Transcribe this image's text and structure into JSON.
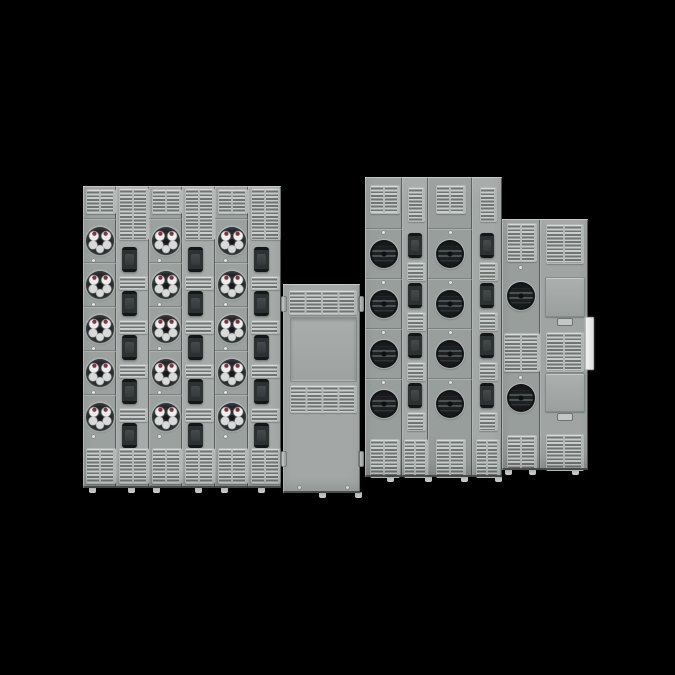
{
  "background": "#000000",
  "product_name": "group-meter-bank-switchboard-render",
  "colors": {
    "panelMeterA": "#9ba19f",
    "panelBreakerA": "#a6aba9",
    "panelMeterC": "#989e9c",
    "panelBreakerC": "#a4a9a7",
    "panelBlank": "#a3a8a6",
    "panelDoorCol": "#a0a5a3",
    "ventFrame": "#b4b9b7",
    "ventSlat": "#c9cdcb",
    "ventSlot": "#6f7573",
    "handleBody": "#2c3132",
    "handleCap": "#141617",
    "handleInner": "#454a4c",
    "socketDark": "#1e2122",
    "socketStripe": "#4b5052",
    "chromeJaw": "#eceeed",
    "chromeJawShade": "#d7dad8",
    "redTerminal": "#8a2f3f",
    "doorFace": "#abb0ae",
    "latchFace": "#c3c7c5",
    "tabFace": "#bfc4c2",
    "footFace": "#ccd0ce",
    "hingeFace": "#f1f3f2",
    "screwFace": "#e4e7e5"
  },
  "banks": [
    {
      "id": "left-meter-bank",
      "x": 83,
      "y": 186,
      "w": 198,
      "h": 302,
      "style": "ring",
      "vent": {
        "w": 28,
        "mTop": 3,
        "mH": 23,
        "bkTop": 2,
        "bkH": 50,
        "bTop": 262,
        "bH": 34
      },
      "meter": {
        "top": 32,
        "pitch": 44,
        "d": 28,
        "screw": "bottom"
      },
      "bk": {
        "top": 61,
        "pitch": 44,
        "hw": 15,
        "hh": 25,
        "hdx": -3,
        "so": 29,
        "sw": 27,
        "sh": 12,
        "tvw": 28,
        "tvsub": 2,
        "bvw": 28
      },
      "columns": [
        {
          "type": "meter",
          "meters": 5,
          "bg": "panelMeterA"
        },
        {
          "type": "breaker",
          "breakers": 5,
          "strips": 4,
          "bg": "panelBreakerA"
        },
        {
          "type": "meter",
          "meters": 5,
          "bg": "panelMeterA"
        },
        {
          "type": "breaker",
          "breakers": 5,
          "strips": 4,
          "bg": "panelBreakerA"
        },
        {
          "type": "meter",
          "meters": 5,
          "bg": "panelMeterA"
        },
        {
          "type": "breaker",
          "breakers": 5,
          "strips": 4,
          "bg": "panelBreakerA"
        }
      ],
      "feet": [
        0.045,
        0.24,
        0.37,
        0.58,
        0.71,
        0.9
      ]
    },
    {
      "id": "center-blank-section",
      "x": 283,
      "y": 284,
      "w": 77,
      "h": 209,
      "style": "blank",
      "bg": "panelBlank",
      "items": [
        {
          "k": "vent",
          "x": 6,
          "y": 6,
          "w": 66,
          "h": 23,
          "sub": 4
        },
        {
          "k": "recess",
          "x": 7,
          "y": 33,
          "w": 65,
          "h": 63
        },
        {
          "k": "vent",
          "x": 7,
          "y": 101,
          "w": 65,
          "h": 26,
          "sub": 4
        },
        {
          "k": "tab",
          "x": -2,
          "y": 12
        },
        {
          "k": "tab",
          "x": -2,
          "y": 167
        },
        {
          "k": "tab",
          "x": 75,
          "y": 12
        },
        {
          "k": "tab",
          "x": 75,
          "y": 167
        },
        {
          "k": "screw",
          "x": 15,
          "y": 202
        },
        {
          "k": "screw",
          "x": 63,
          "y": 202
        }
      ],
      "feet": [
        0.5,
        0.97
      ]
    },
    {
      "id": "right-meter-bank",
      "x": 365,
      "y": 177,
      "w": 137,
      "h": 300,
      "style": "ringless",
      "vent": {
        "w": 28,
        "mTop": 8,
        "mH": 27,
        "bkTop": 10,
        "bkH": 33,
        "bTop": 262,
        "bH": 37
      },
      "meter": {
        "top": 51,
        "pitch": 50,
        "d": 28,
        "screw": "top"
      },
      "bk": {
        "top": 56,
        "pitch": 50,
        "hw": 14,
        "hh": 25,
        "hdx": 0,
        "so": 29,
        "sw": 17,
        "sh": 17,
        "tvw": 15,
        "tvsub": 1,
        "bvw": 22
      },
      "columns": [
        {
          "type": "meter",
          "meters": 4,
          "w": 37,
          "bg": "panelMeterC"
        },
        {
          "type": "breaker",
          "breakers": 4,
          "strips": 4,
          "w": 26,
          "bg": "panelBreakerC"
        },
        {
          "type": "meter",
          "meters": 4,
          "w": 44,
          "bg": "panelMeterC"
        },
        {
          "type": "breaker",
          "breakers": 4,
          "strips": 4,
          "w": 30,
          "bg": "panelBreakerC"
        }
      ],
      "feet": [
        0.18,
        0.46,
        0.72,
        0.97
      ]
    },
    {
      "id": "far-right-meter-bank",
      "x": 502,
      "y": 219,
      "w": 86,
      "h": 251,
      "style": "ringless",
      "columns": [
        {
          "type": "custom",
          "name": "meter-column",
          "w": 38,
          "bg": "panelMeterC",
          "items": [
            {
              "k": "vent",
              "x": 5,
              "y": 4,
              "w": 28,
              "h": 37
            },
            {
              "k": "screw",
              "x": 17,
              "y": 47
            },
            {
              "k": "meter",
              "x": 5,
              "y": 63,
              "d": 28
            },
            {
              "k": "vent",
              "x": 2,
              "y": 114,
              "w": 34,
              "h": 37
            },
            {
              "k": "screw",
              "x": 17,
              "y": 157
            },
            {
              "k": "meter",
              "x": 5,
              "y": 165,
              "d": 28
            },
            {
              "k": "vent",
              "x": 5,
              "y": 216,
              "w": 28,
              "h": 33
            }
          ]
        },
        {
          "type": "custom",
          "name": "blank-door-column",
          "w": 48,
          "bg": "panelDoorCol",
          "items": [
            {
              "k": "vent",
              "x": 6,
              "y": 5,
              "w": 36,
              "h": 38
            },
            {
              "k": "door",
              "x": 5,
              "y": 58,
              "w": 38,
              "h": 38
            },
            {
              "k": "latch",
              "x": 17,
              "y": 99,
              "w": 14,
              "h": 6
            },
            {
              "k": "vent",
              "x": 6,
              "y": 113,
              "w": 36,
              "h": 38
            },
            {
              "k": "door",
              "x": 5,
              "y": 154,
              "w": 38,
              "h": 37
            },
            {
              "k": "latch",
              "x": 17,
              "y": 194,
              "w": 14,
              "h": 6
            },
            {
              "k": "vent",
              "x": 6,
              "y": 215,
              "w": 36,
              "h": 35
            }
          ]
        }
      ],
      "feet": [
        0.07,
        0.35,
        0.85
      ],
      "hinge": {
        "x": 585,
        "y": 317,
        "w": 7,
        "h": 51
      }
    }
  ]
}
